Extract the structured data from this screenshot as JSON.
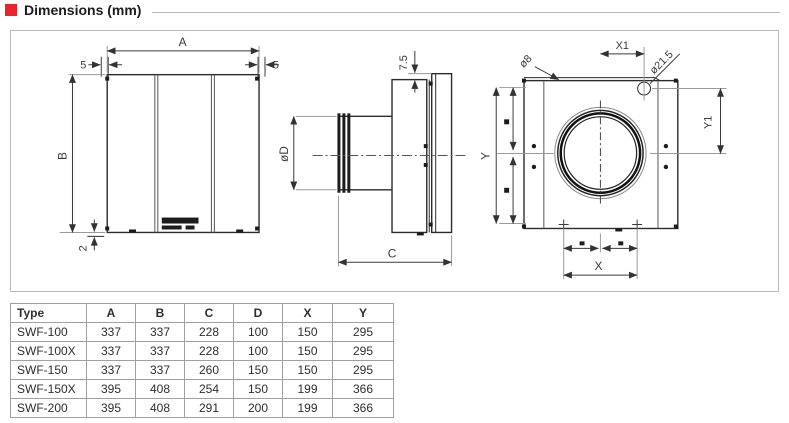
{
  "header": {
    "title": "Dimensions (mm)",
    "accent_color": "#e8232b"
  },
  "diagram": {
    "front": {
      "dim_a": "A",
      "dim_b": "B",
      "dim_five_left": "5",
      "dim_five_right": "5",
      "dim_two": "2"
    },
    "side": {
      "dim_seven_five": "7.5",
      "dim_diameter": "øD",
      "dim_c": "C"
    },
    "back": {
      "dim_x1": "X1",
      "dim_hole": "ø8",
      "dim_knockout": "ø21.5",
      "dim_y1": "Y1",
      "dim_y": "Y",
      "dim_x": "X"
    }
  },
  "table": {
    "columns": [
      "Type",
      "A",
      "B",
      "C",
      "D",
      "X",
      "Y"
    ],
    "rows": [
      [
        "SWF-100",
        "337",
        "337",
        "228",
        "100",
        "150",
        "295"
      ],
      [
        "SWF-100X",
        "337",
        "337",
        "228",
        "100",
        "150",
        "295"
      ],
      [
        "SWF-150",
        "337",
        "337",
        "260",
        "150",
        "150",
        "295"
      ],
      [
        "SWF-150X",
        "395",
        "408",
        "254",
        "150",
        "199",
        "366"
      ],
      [
        "SWF-200",
        "395",
        "408",
        "291",
        "200",
        "199",
        "366"
      ]
    ]
  }
}
